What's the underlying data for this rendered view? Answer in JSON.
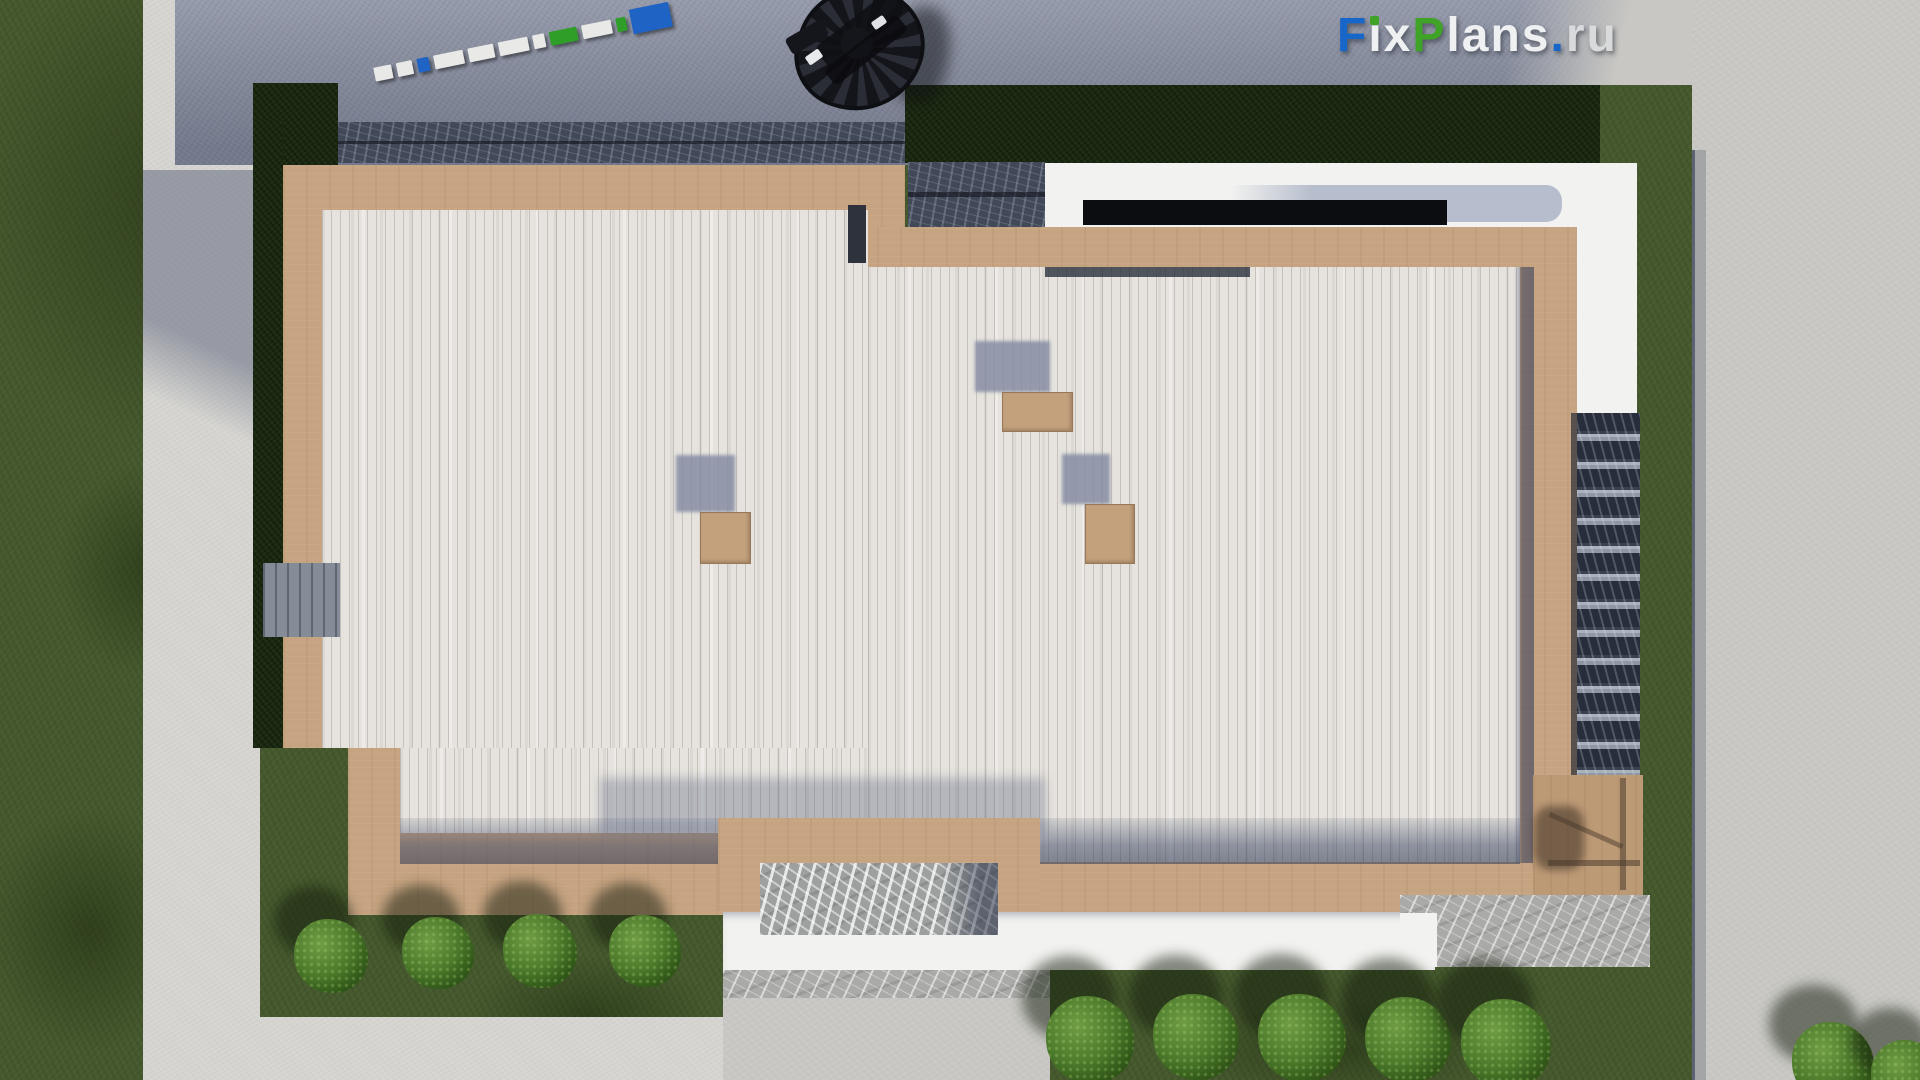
{
  "watermark": {
    "text": "FixPlans.ru",
    "letters": [
      {
        "ch": "F",
        "color": "#1766c9"
      },
      {
        "ch": "i",
        "color": "#eef0f2",
        "dot": "#3ea326"
      },
      {
        "ch": "x",
        "color": "#eef0f2"
      },
      {
        "ch": "P",
        "color": "#3ea326"
      },
      {
        "ch": "l",
        "color": "#eef0f2"
      },
      {
        "ch": "a",
        "color": "#eef0f2"
      },
      {
        "ch": "n",
        "color": "#eef0f2"
      },
      {
        "ch": "s",
        "color": "#eef0f2"
      },
      {
        "ch": ".",
        "color": "#1766c9"
      },
      {
        "ch": "r",
        "color": "#d9dadb"
      },
      {
        "ch": "u",
        "color": "#d9dadb"
      }
    ]
  },
  "scene": {
    "type": "aerial-roof-plan-render",
    "description": "Top-down 3D architectural render of a modern flat-roof house: white plank roof deck with wooden tan border, three roof hatches with shadows, white parapet wing with dark glazing, side stone stair, marble patios, concrete walkways, lawns, hedges and trimmed shrubs",
    "ruler_segments": [
      {
        "w": 18,
        "c": "white"
      },
      {
        "w": 16,
        "c": "white"
      },
      {
        "w": 12,
        "c": "blue"
      },
      {
        "w": 30,
        "c": "white"
      },
      {
        "w": 26,
        "c": "white"
      },
      {
        "w": 30,
        "c": "white"
      },
      {
        "w": 12,
        "c": "white"
      },
      {
        "w": 28,
        "c": "green"
      },
      {
        "w": 30,
        "c": "white"
      },
      {
        "w": 10,
        "c": "green"
      },
      {
        "w": 40,
        "c": "blue",
        "tall": true
      }
    ],
    "ruler_colors": {
      "white": "#e9e9e7",
      "blue": "#1f63c4",
      "green": "#2f9e28"
    },
    "vents": [
      {
        "shadow": [
          975,
          341,
          75,
          51
        ],
        "box": [
          1002,
          392,
          69,
          38
        ]
      },
      {
        "shadow": [
          676,
          455,
          59,
          57
        ],
        "box": [
          700,
          512,
          49,
          50
        ]
      },
      {
        "shadow": [
          1062,
          454,
          48,
          50
        ],
        "box": [
          1085,
          504,
          48,
          58
        ]
      }
    ],
    "bushes": {
      "left_row": [
        {
          "x": 331,
          "y": 956,
          "r": 37
        },
        {
          "x": 438,
          "y": 953,
          "r": 36
        },
        {
          "x": 540,
          "y": 951,
          "r": 37
        },
        {
          "x": 645,
          "y": 951,
          "r": 36
        }
      ],
      "right_row": [
        {
          "x": 1090,
          "y": 1040,
          "r": 44
        },
        {
          "x": 1196,
          "y": 1037,
          "r": 43
        },
        {
          "x": 1302,
          "y": 1038,
          "r": 44
        },
        {
          "x": 1408,
          "y": 1040,
          "r": 43
        },
        {
          "x": 1506,
          "y": 1044,
          "r": 45
        }
      ],
      "corner": [
        {
          "x": 1833,
          "y": 1063,
          "r": 41
        },
        {
          "x": 1907,
          "y": 1076,
          "r": 36
        }
      ]
    },
    "palette": {
      "grass": "#46592e",
      "hedge": "#1b2912",
      "walkway_concrete": "#d5d4d0",
      "sunlit_concrete": "#c8c7c3",
      "asphalt_pavement": "#8a90a2",
      "granite_curb": "#414857",
      "deck_border_tan": "#c6a381",
      "roof_planks": "#e6e3de",
      "parapet_white": "#f2f2f0",
      "glass_band": "#b6bdcc",
      "glazing_black": "#0c0d10",
      "marble": "#aaaaa8",
      "stair_dark": "#272d3a",
      "shadow_blue": "#6a7288"
    }
  }
}
